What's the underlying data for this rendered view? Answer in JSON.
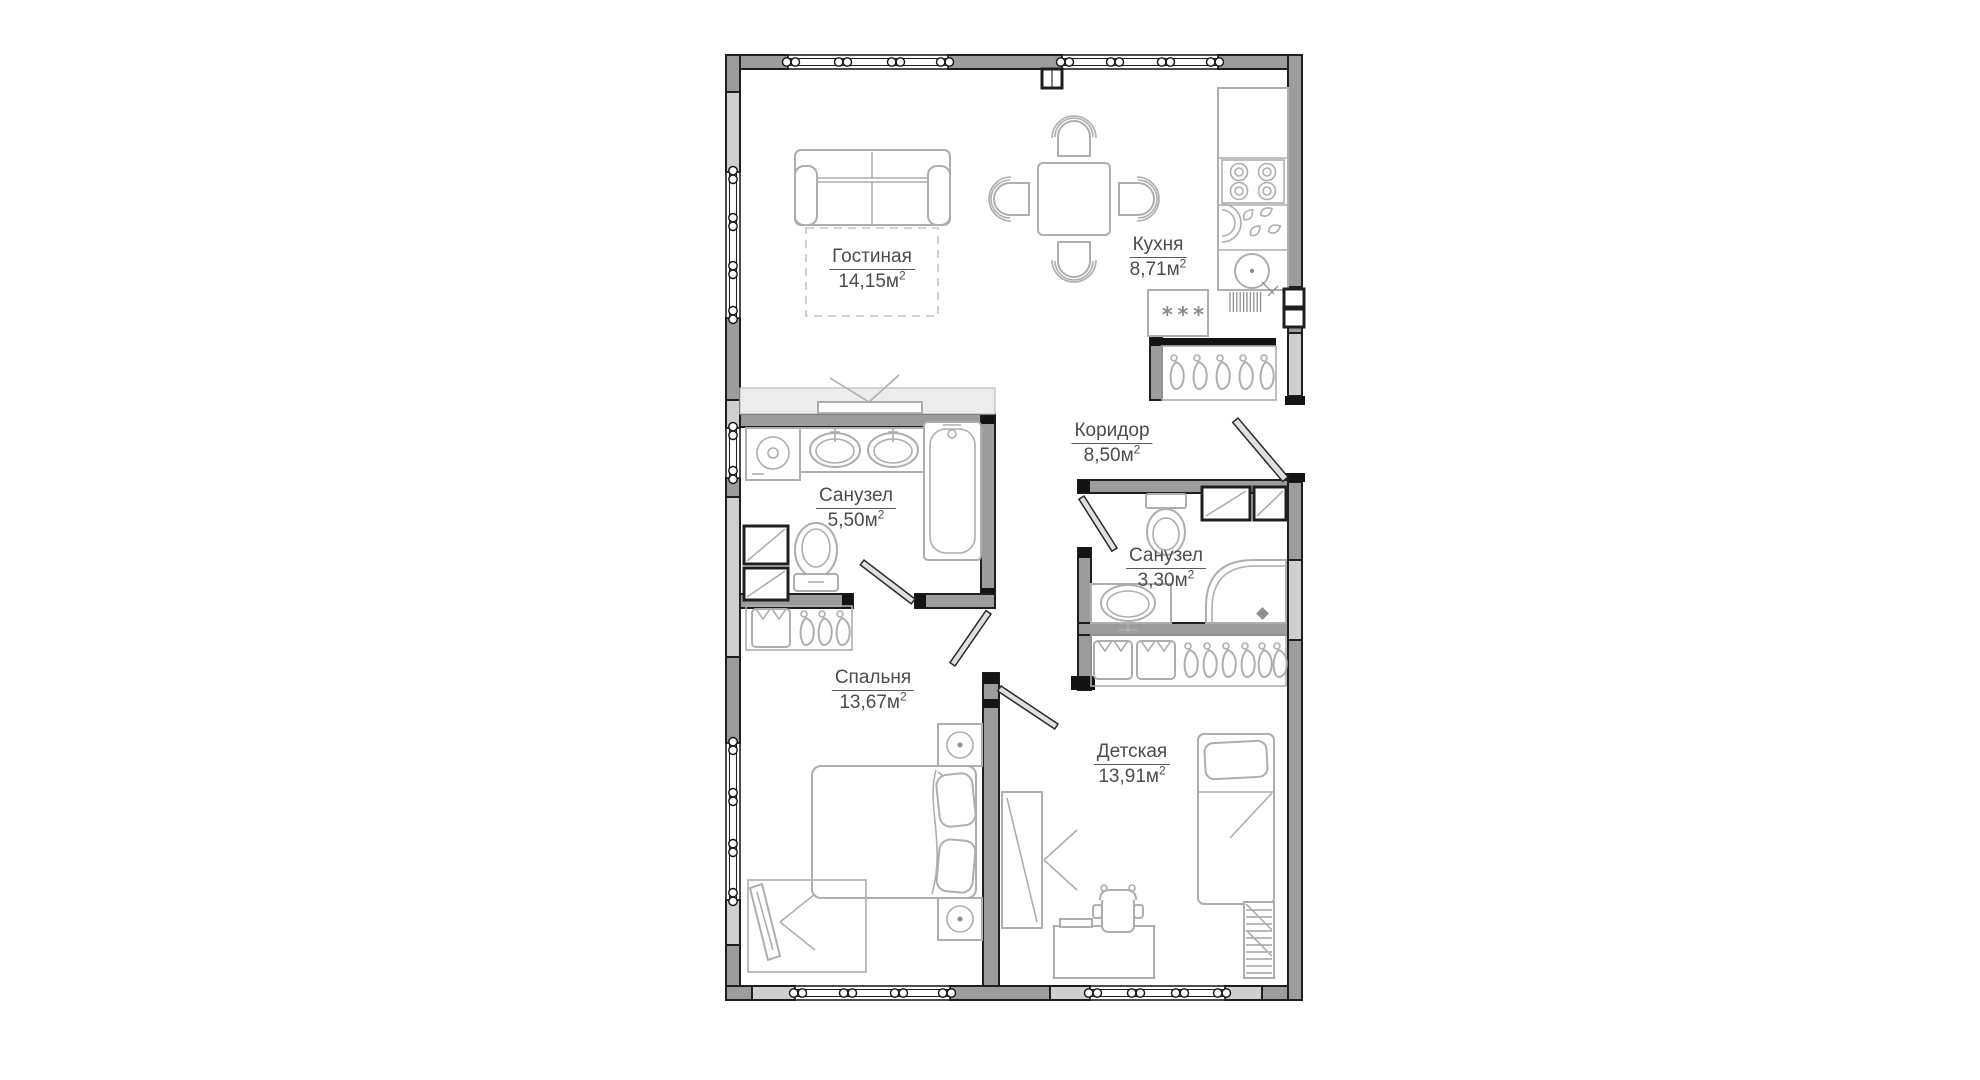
{
  "plan": {
    "title": "apartment-floor-plan",
    "rooms": [
      {
        "key": "living",
        "name": "Гостиная",
        "area": "14,15м",
        "sup": "2"
      },
      {
        "key": "kitchen",
        "name": "Кухня",
        "area": "8,71м",
        "sup": "2"
      },
      {
        "key": "corridor",
        "name": "Коридор",
        "area": "8,50м",
        "sup": "2"
      },
      {
        "key": "bath-big",
        "name": "Санузел",
        "area": "5,50м",
        "sup": "2"
      },
      {
        "key": "bath-small",
        "name": "Санузел",
        "area": "3,30м",
        "sup": "2"
      },
      {
        "key": "bedroom",
        "name": "Спальня",
        "area": "13,67м",
        "sup": "2"
      },
      {
        "key": "kids",
        "name": "Детская",
        "area": "13,91м",
        "sup": "2"
      }
    ],
    "symbols": {
      "freezer": "***"
    },
    "colors": {
      "wall": "#9c9c9c",
      "wall_light": "#cfcfcf",
      "outline": "#1f1f1f",
      "furniture_stroke": "#aeaeae",
      "label_text": "#4c4c4c",
      "background": "#ffffff"
    }
  }
}
